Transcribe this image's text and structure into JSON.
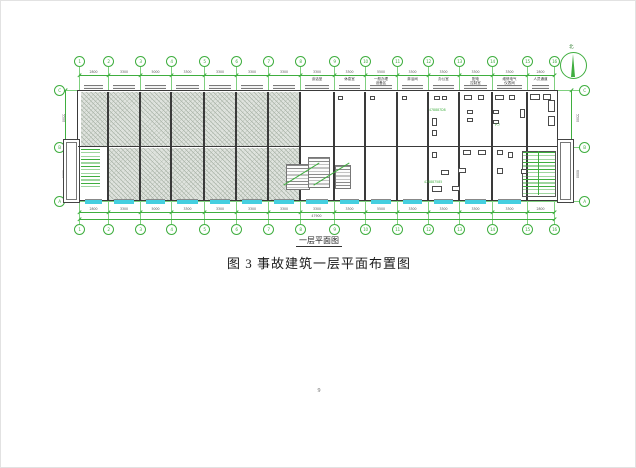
{
  "figure": {
    "drawing_title": "一层平面图",
    "caption": "图 3 事故建筑一层平面布置图",
    "north_label": "北",
    "grid": {
      "col_labels": [
        "1",
        "2",
        "3",
        "4",
        "5",
        "6",
        "7",
        "8",
        "9",
        "10",
        "11",
        "12",
        "13",
        "14",
        "15",
        "16"
      ],
      "col_dims": [
        "2800",
        "3300",
        "5000",
        "3300",
        "3300",
        "3300",
        "3300",
        "3300",
        "3300",
        "5500",
        "3300",
        "3300",
        "3300",
        "3300",
        "2800"
      ],
      "total_dim": "47900",
      "row_labels": [
        "C",
        "B",
        "A"
      ],
      "row_dims": [
        "5500",
        "6000"
      ]
    },
    "rooms": [
      "谈话室",
      "休息室",
      "一般办理\n设备区",
      "淋浴间",
      "办公室",
      "配电\n控制室",
      "维修电气\n仪表间",
      "人员通道"
    ],
    "annotations": [
      "478887D8",
      "478887585",
      "P-7"
    ]
  },
  "page": {
    "number": "9"
  },
  "colors": {
    "grid_green": "#3fae3f",
    "grid_green_light": "#7fd07f",
    "window_cyan": "#45cfe0",
    "wall_dark": "#3a3a3a",
    "hatch_bg": "#dfe3de",
    "hatch_line": "#a9b3a7"
  }
}
